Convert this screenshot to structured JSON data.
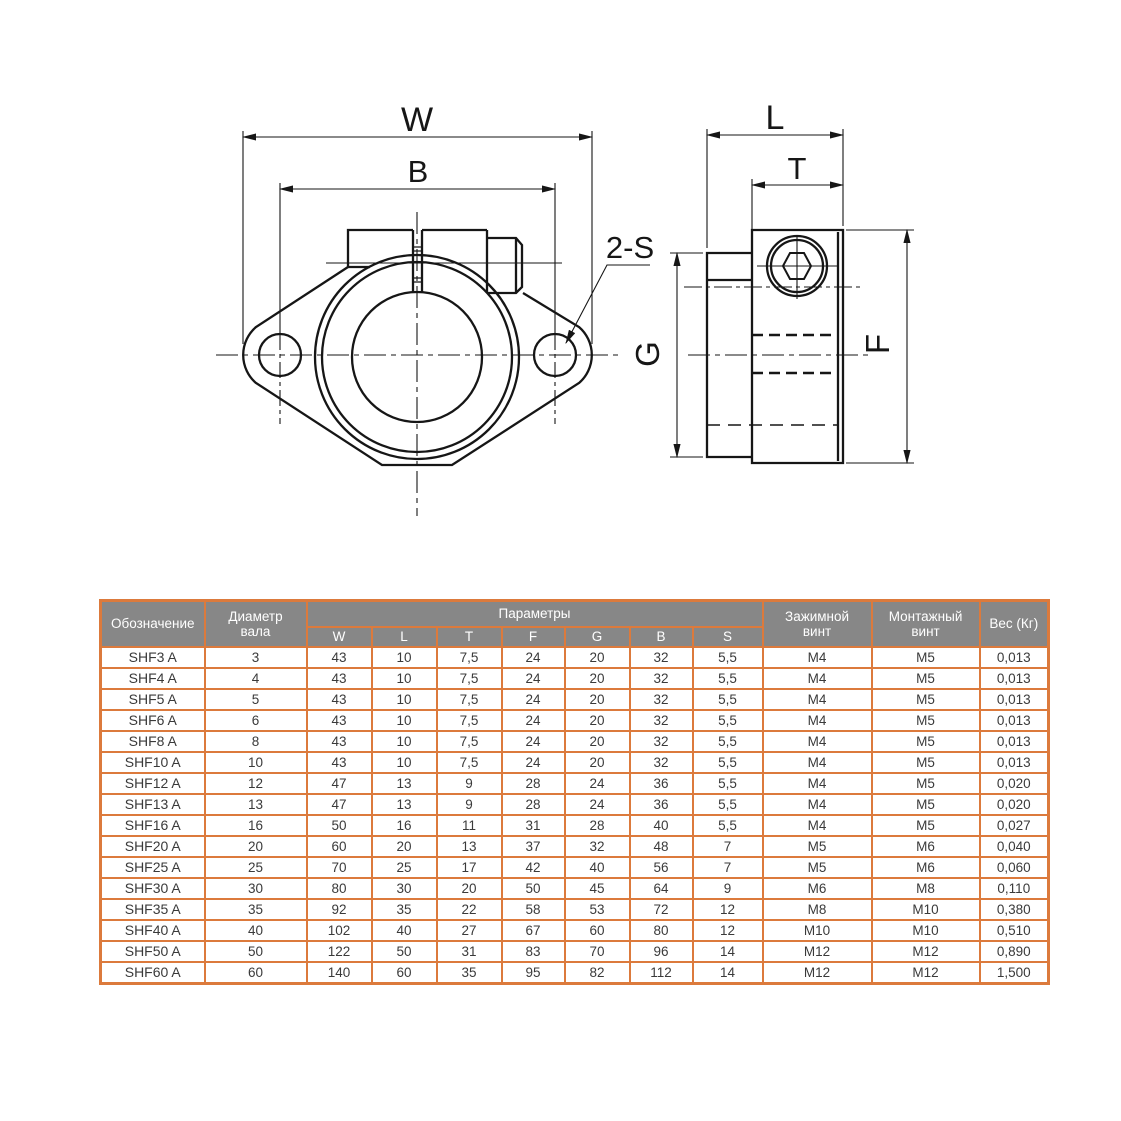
{
  "drawing": {
    "front_view": {
      "width_label": "W",
      "bolt_spacing_label": "B",
      "holes_label": "2-S"
    },
    "side_view": {
      "length_label": "L",
      "clamp_width_label": "T",
      "height_label": "F",
      "flange_height_label": "G"
    }
  },
  "table": {
    "headers": {
      "designation": "Обозначение",
      "shaft_diameter": "Диаметр вала",
      "parameters": "Параметры",
      "clamp_screw": "Зажимной винт",
      "mount_screw": "Монтажный винт",
      "weight": "Вес (Кг)"
    },
    "param_headers": [
      "W",
      "L",
      "T",
      "F",
      "G",
      "B",
      "S"
    ],
    "rows": [
      [
        "SHF3 A",
        "3",
        "43",
        "10",
        "7,5",
        "24",
        "20",
        "32",
        "5,5",
        "M4",
        "M5",
        "0,013"
      ],
      [
        "SHF4 A",
        "4",
        "43",
        "10",
        "7,5",
        "24",
        "20",
        "32",
        "5,5",
        "M4",
        "M5",
        "0,013"
      ],
      [
        "SHF5 A",
        "5",
        "43",
        "10",
        "7,5",
        "24",
        "20",
        "32",
        "5,5",
        "M4",
        "M5",
        "0,013"
      ],
      [
        "SHF6 A",
        "6",
        "43",
        "10",
        "7,5",
        "24",
        "20",
        "32",
        "5,5",
        "M4",
        "M5",
        "0,013"
      ],
      [
        "SHF8 A",
        "8",
        "43",
        "10",
        "7,5",
        "24",
        "20",
        "32",
        "5,5",
        "M4",
        "M5",
        "0,013"
      ],
      [
        "SHF10 A",
        "10",
        "43",
        "10",
        "7,5",
        "24",
        "20",
        "32",
        "5,5",
        "M4",
        "M5",
        "0,013"
      ],
      [
        "SHF12 A",
        "12",
        "47",
        "13",
        "9",
        "28",
        "24",
        "36",
        "5,5",
        "M4",
        "M5",
        "0,020"
      ],
      [
        "SHF13 A",
        "13",
        "47",
        "13",
        "9",
        "28",
        "24",
        "36",
        "5,5",
        "M4",
        "M5",
        "0,020"
      ],
      [
        "SHF16 A",
        "16",
        "50",
        "16",
        "11",
        "31",
        "28",
        "40",
        "5,5",
        "M4",
        "M5",
        "0,027"
      ],
      [
        "SHF20 A",
        "20",
        "60",
        "20",
        "13",
        "37",
        "32",
        "48",
        "7",
        "M5",
        "M6",
        "0,040"
      ],
      [
        "SHF25 A",
        "25",
        "70",
        "25",
        "17",
        "42",
        "40",
        "56",
        "7",
        "M5",
        "M6",
        "0,060"
      ],
      [
        "SHF30 A",
        "30",
        "80",
        "30",
        "20",
        "50",
        "45",
        "64",
        "9",
        "M6",
        "M8",
        "0,110"
      ],
      [
        "SHF35 A",
        "35",
        "92",
        "35",
        "22",
        "58",
        "53",
        "72",
        "12",
        "M8",
        "M10",
        "0,380"
      ],
      [
        "SHF40 A",
        "40",
        "102",
        "40",
        "27",
        "67",
        "60",
        "80",
        "12",
        "M10",
        "M10",
        "0,510"
      ],
      [
        "SHF50 A",
        "50",
        "122",
        "50",
        "31",
        "83",
        "70",
        "96",
        "14",
        "M12",
        "M12",
        "0,890"
      ],
      [
        "SHF60 A",
        "60",
        "140",
        "60",
        "35",
        "95",
        "82",
        "112",
        "14",
        "M12",
        "M12",
        "1,500"
      ]
    ]
  },
  "colors": {
    "table_border": "#DC7A3C",
    "header_bg": "#878787",
    "header_text": "#FFFFFF",
    "cell_text": "#3A3A3A",
    "line": "#161616"
  }
}
